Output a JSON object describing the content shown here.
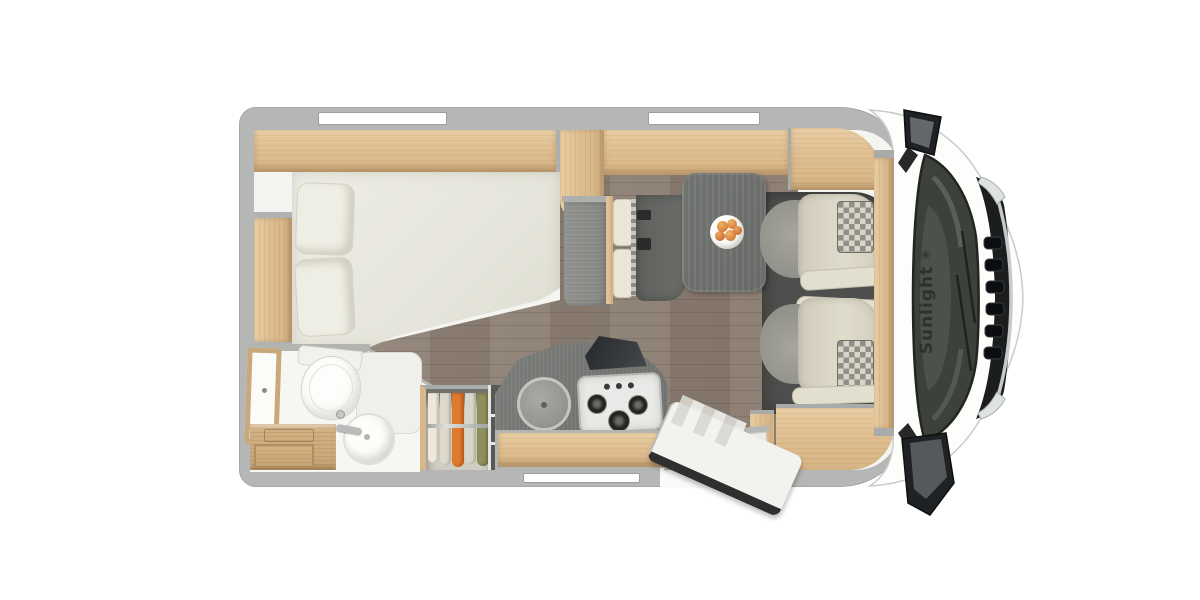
{
  "brand": {
    "name": "Sunlight",
    "mark": "✳"
  },
  "colors": {
    "background": "#ffffff",
    "shell_wall": "#b5b7b6",
    "interior": "#f4f4f1",
    "wood": "#dfbf92",
    "floor": "#8b7d71",
    "counter": "#70726f",
    "bed": "#e9e8df",
    "seat_beige": "#ddd9c9",
    "seat_gray": "#9b9b93",
    "cab_floor": "#4e4f4d",
    "windshield": "#3c413a",
    "grille": "#1b1d1f",
    "accent_fruit": "#d97f3a"
  },
  "fixtures": {
    "bed": "french-bed",
    "wardrobe": "wardrobe-hanging-clothes",
    "bathroom": "bathroom-toilet-sink-shower",
    "kitchen": "kitchen-sink-3-burner-stove",
    "dinette": "dinette-bench-and-table",
    "cab": "cab-two-swivel-seats",
    "door": "entry-door-open",
    "windows": "two-roof-windows"
  }
}
